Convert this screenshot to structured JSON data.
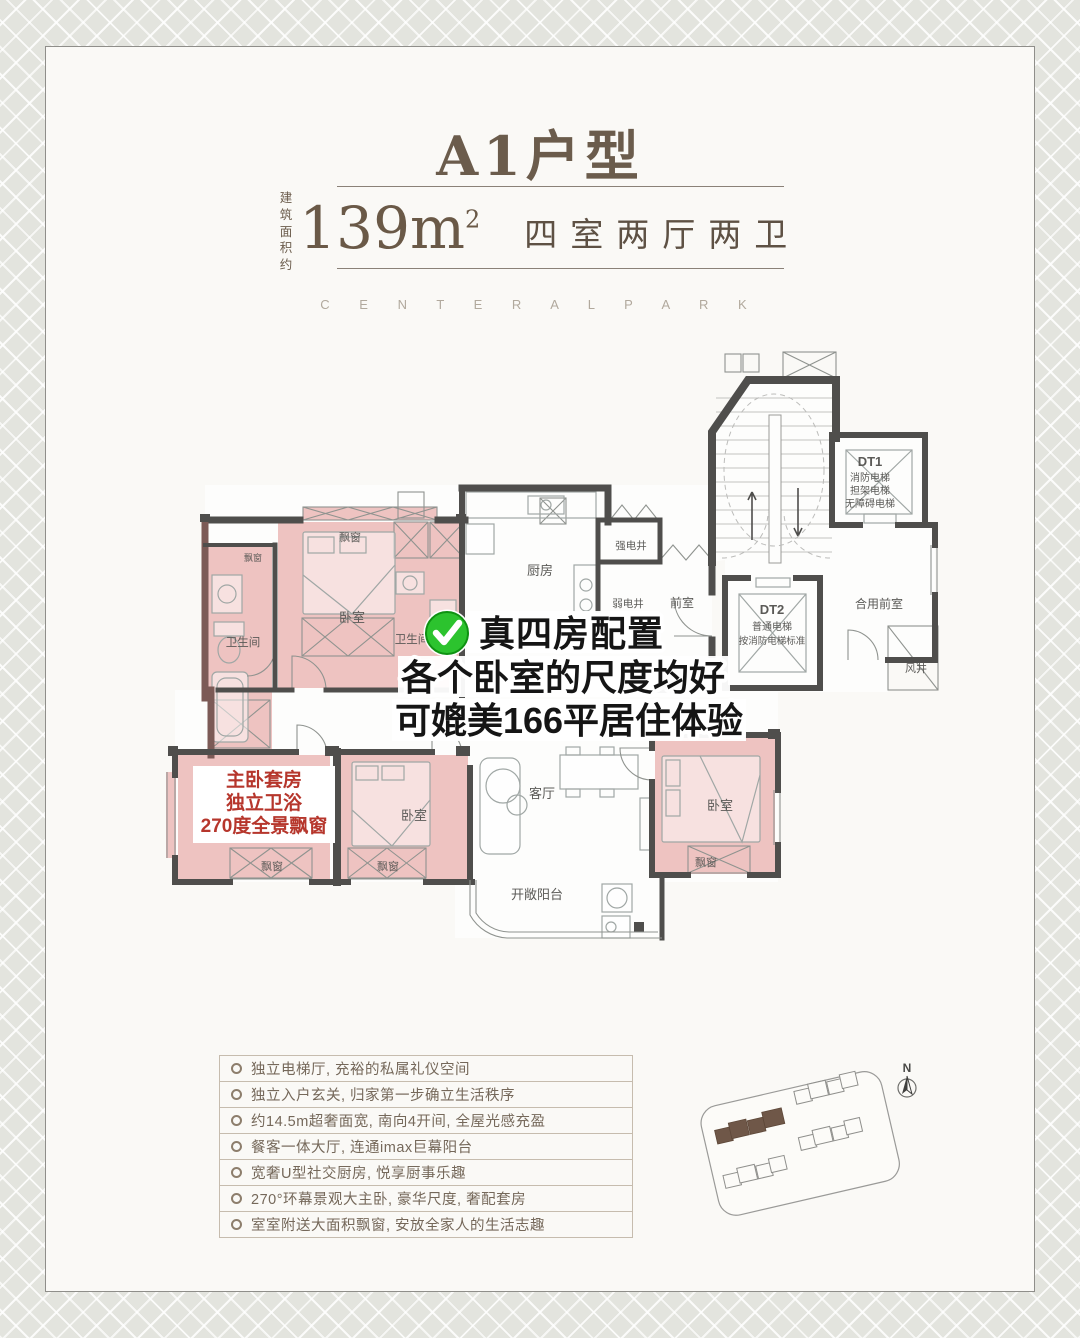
{
  "header": {
    "title": "A1户型",
    "area_label_top": "建 筑",
    "area_label_bottom": "面积约",
    "area_value": "139m",
    "area_unit_sup": "2",
    "layout": "四室两厅两卫",
    "subtitle": "C E N T E R A L   P A R K"
  },
  "overlay": {
    "line1": "真四房配置",
    "line2": "各个卧室的尺度均好",
    "line3": "可媲美166平居住体验"
  },
  "master_callout": {
    "line1": "主卧套房",
    "line2": "独立卫浴",
    "line3": "270度全景飘窗"
  },
  "floorplan": {
    "bedroom": "卧室",
    "bathroom": "卫生间",
    "kitchen": "厨房",
    "living_room": "客厅",
    "balcony": "开敞阳台",
    "bay_window": "飘窗",
    "strong_elec_shaft": "强电井",
    "weak_elec_shaft": "弱电井",
    "vestibule": "前室",
    "shared_vestibule": "合用前室",
    "wind_shaft": "风井",
    "dt1": {
      "name": "DT1",
      "line1": "消防电梯",
      "line2": "担架电梯",
      "line3": "无障碍电梯"
    },
    "dt2": {
      "name": "DT2",
      "line1": "普通电梯",
      "line2": "按消防电梯标准"
    }
  },
  "features": {
    "items": [
      "独立电梯厅, 充裕的私属礼仪空间",
      "独立入户玄关, 归家第一步确立生活秩序",
      "约14.5m超奢面宽, 南向4开间, 全屋光感充盈",
      "餐客一体大厅, 连通imax巨幕阳台",
      "宽奢U型社交厨房, 悦享厨事乐趣",
      "270°环幕景观大主卧, 豪华尺度, 奢配套房",
      "室室附送大面积飘窗, 安放全家人的生活志趣"
    ]
  },
  "sitemap": {
    "north": "N"
  },
  "colors": {
    "accent_green": "#2cc32e",
    "highlight_pink": "#eec3c1",
    "callout_red": "#b6362c",
    "title_brown": "#6b5c4c",
    "wall_gray": "#4f4e4c",
    "site_building_brown": "#6f5748"
  }
}
